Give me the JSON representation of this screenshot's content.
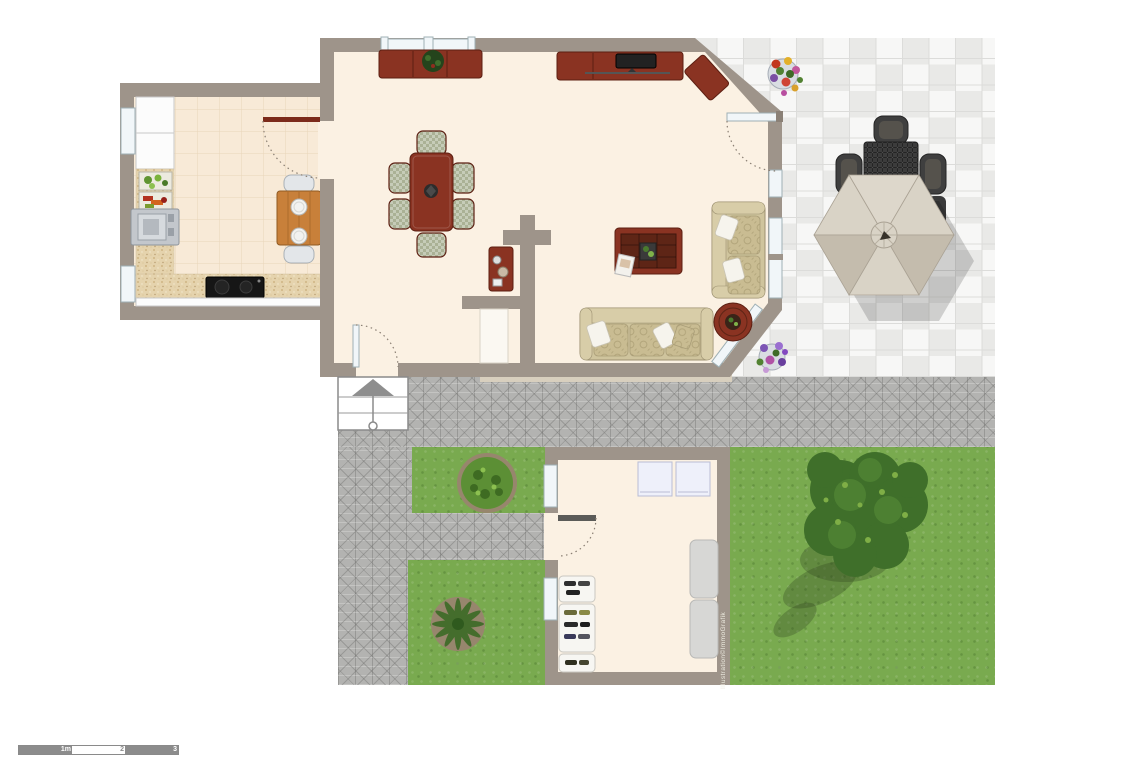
{
  "watermark": "Illustration©ImmoGrafik",
  "scale_bar": {
    "labels": [
      "1m",
      "2",
      "3"
    ]
  },
  "colors": {
    "wall": "#9e948a",
    "wall_dark": "#8b8177",
    "floor": "#fbf1e3",
    "kitchen_tile": "#f8ead7",
    "kitchen_tile_line": "#e9d5ba",
    "counter_speckle": "#e5d3ad",
    "wood": "#8a3322",
    "wood_dark": "#5c1f12",
    "door_wood": "#7c2b1b",
    "pine": "#c8803a",
    "pine_dark": "#8f5a22",
    "chair_a": "#c6ccb8",
    "chair_b": "#aab195",
    "sofa": "#cfc49d",
    "sofa_raised": "#d8cda8",
    "sofa_trim": "#9c9171",
    "cushion": "#c9bc92",
    "pillow": "#f6f4ed",
    "tile_light": "#f7f7f6",
    "tile_dark": "#e9e9e7",
    "tile_line": "#dcdcda",
    "paving": "#b3b3b1",
    "grass": "#79aa4f",
    "canopy_light": "#d9d3c6",
    "canopy_dark": "#c4bcad",
    "wicker": "#3c3c3c",
    "wicker_dark": "#242424",
    "window_fill": "#f1f6f9",
    "window_stroke": "#9fb0b5",
    "stair_gray": "#8e8e8e",
    "scale_gray": "#8c8c8c",
    "gravel": "#d8cfbe",
    "tree_green": "#3f6f2a",
    "bush_green": "#5c8f35",
    "earth": "#97866d"
  },
  "legend": {
    "rooms": [
      "kitchen",
      "living-dining-room",
      "entrance-hall",
      "garden-shed",
      "patio",
      "garden",
      "paved-court",
      "entrance-stairs"
    ],
    "furniture": [
      "dining-table-six-chairs",
      "sideboard-with-plant",
      "tv-lowboard",
      "console-table",
      "coffee-table",
      "two-seat-sofa",
      "three-seat-sofa",
      "round-side-table",
      "kitchen-table-two-chairs",
      "stove",
      "cooktop-sink",
      "patio-dining-set",
      "patio-umbrella",
      "flower-pot",
      "storage-boxes",
      "shoe-shelves",
      "loungers",
      "tree",
      "bush",
      "grass-plant"
    ]
  }
}
